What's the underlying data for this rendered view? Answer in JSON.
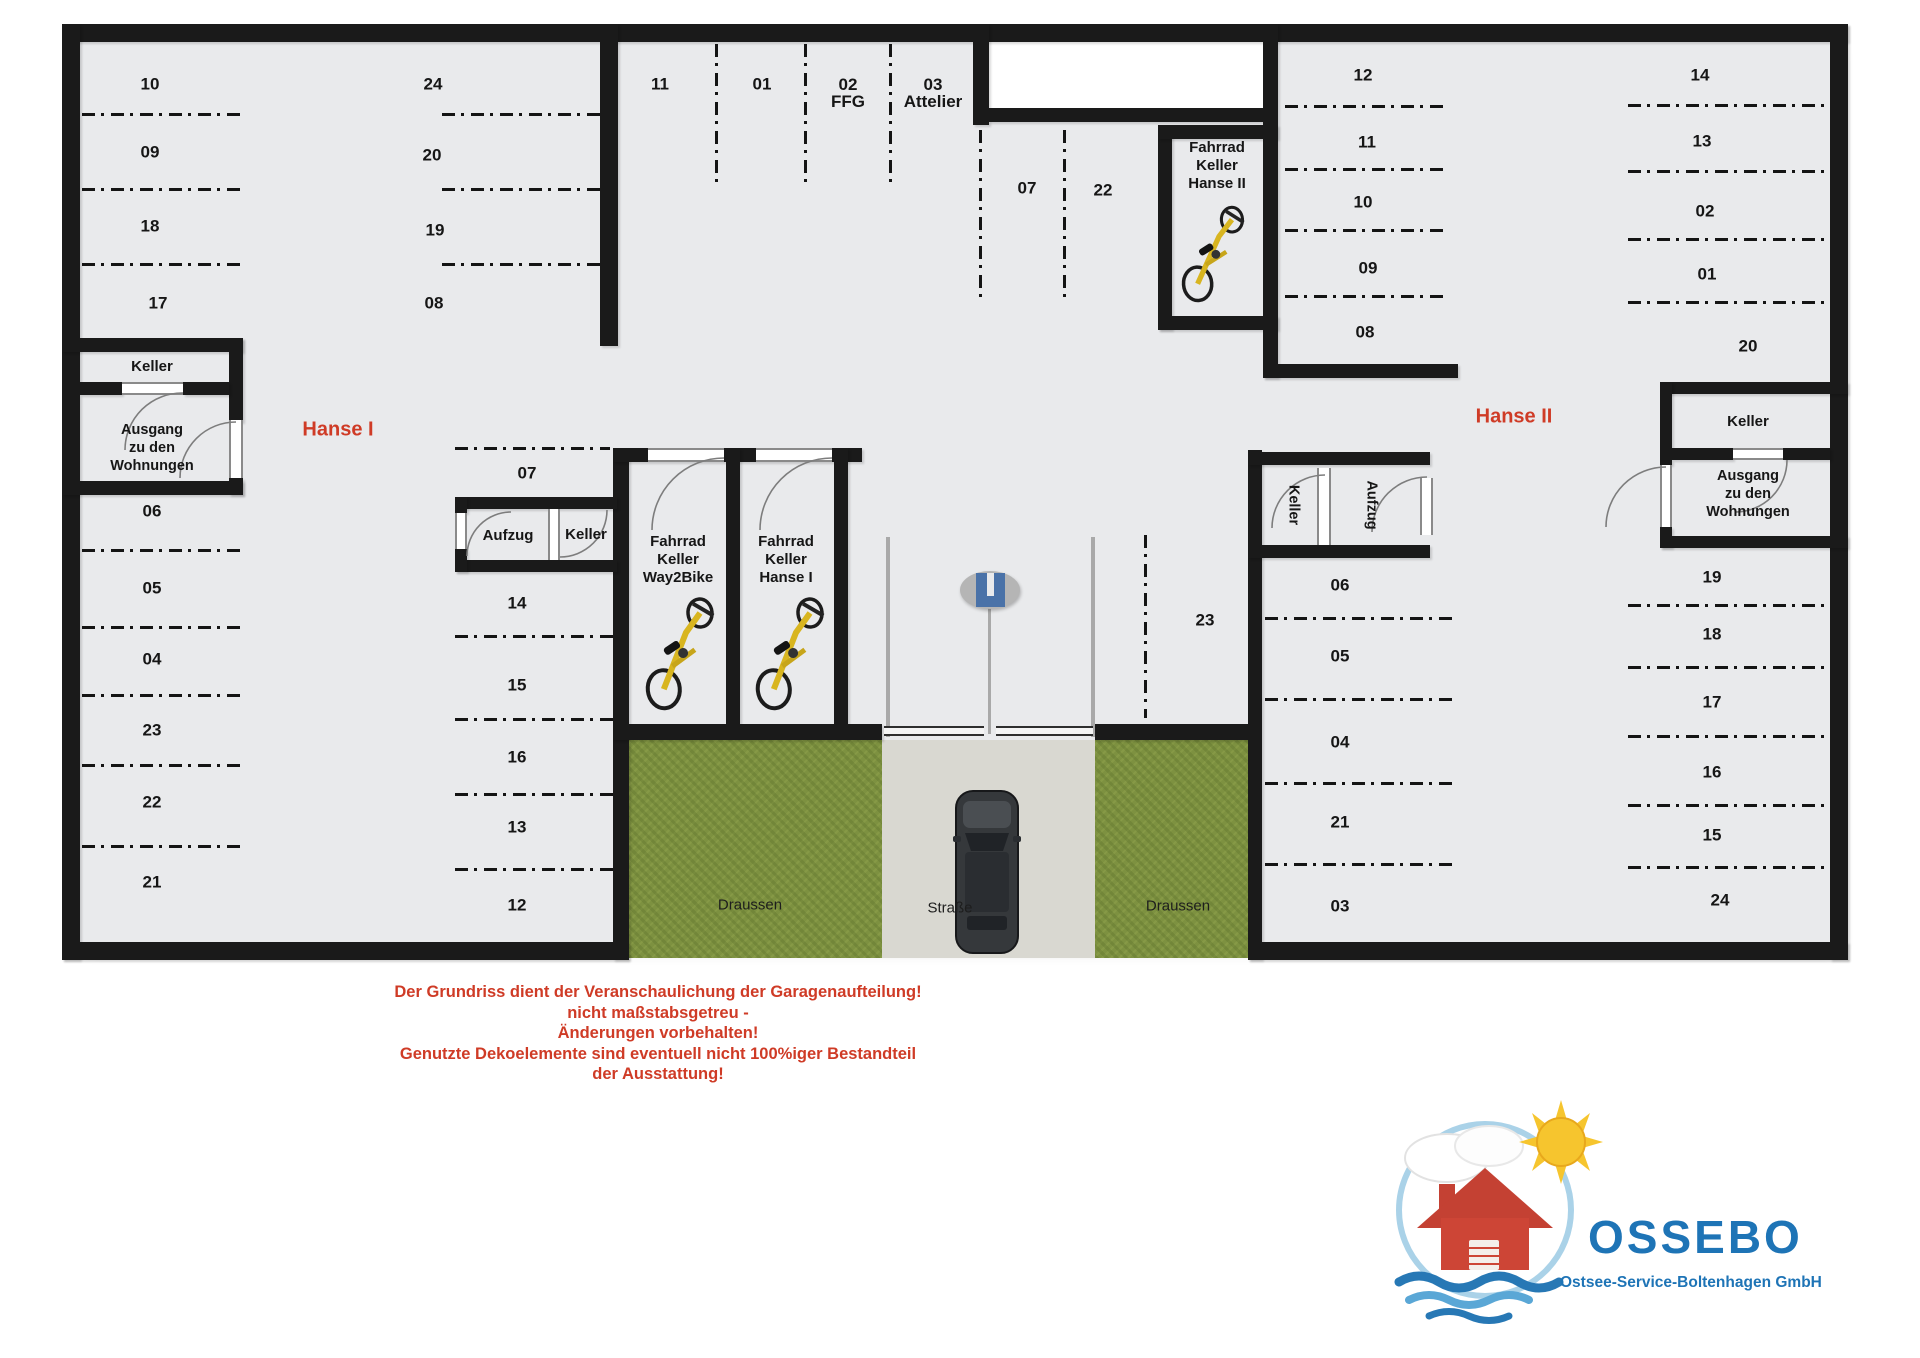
{
  "colors": {
    "accent_red": "#cf3b26",
    "logo_blue": "#1e74b6",
    "wall": "#1a1a1a",
    "floor_gray": "#e9eaec",
    "grass_green": "#7d9140",
    "road_gray": "#d9d8d1",
    "bike_yellow": "#d8b520",
    "sign_blue": "#4a72a8"
  },
  "plan": {
    "building_left": "Hanse I",
    "building_right": "Hanse II",
    "parking_spots": [
      {
        "label": "10",
        "x": 150,
        "y": 84
      },
      {
        "label": "09",
        "x": 150,
        "y": 152
      },
      {
        "label": "18",
        "x": 150,
        "y": 226
      },
      {
        "label": "17",
        "x": 158,
        "y": 303
      },
      {
        "label": "24",
        "x": 433,
        "y": 84
      },
      {
        "label": "20",
        "x": 432,
        "y": 155
      },
      {
        "label": "19",
        "x": 435,
        "y": 230
      },
      {
        "label": "08",
        "x": 434,
        "y": 303
      },
      {
        "label": "11",
        "x": 660,
        "y": 84
      },
      {
        "label": "01",
        "x": 762,
        "y": 84
      },
      {
        "label": "02",
        "line2": "FFG",
        "x": 848,
        "y": 93
      },
      {
        "label": "03",
        "line2": "Attelier",
        "x": 933,
        "y": 93
      },
      {
        "label": "07",
        "x": 1027,
        "y": 188
      },
      {
        "label": "22",
        "x": 1103,
        "y": 190
      },
      {
        "label": "06",
        "x": 152,
        "y": 511
      },
      {
        "label": "05",
        "x": 152,
        "y": 588
      },
      {
        "label": "04",
        "x": 152,
        "y": 659
      },
      {
        "label": "23",
        "x": 152,
        "y": 730
      },
      {
        "label": "22",
        "x": 152,
        "y": 802
      },
      {
        "label": "21",
        "x": 152,
        "y": 882
      },
      {
        "label": "07",
        "x": 527,
        "y": 473
      },
      {
        "label": "14",
        "x": 517,
        "y": 603
      },
      {
        "label": "15",
        "x": 517,
        "y": 685
      },
      {
        "label": "16",
        "x": 517,
        "y": 757
      },
      {
        "label": "13",
        "x": 517,
        "y": 827
      },
      {
        "label": "12",
        "x": 517,
        "y": 905
      },
      {
        "label": "12",
        "x": 1363,
        "y": 75
      },
      {
        "label": "11",
        "x": 1367,
        "y": 142
      },
      {
        "label": "10",
        "x": 1363,
        "y": 202
      },
      {
        "label": "09",
        "x": 1368,
        "y": 268
      },
      {
        "label": "08",
        "x": 1365,
        "y": 332
      },
      {
        "label": "14",
        "x": 1700,
        "y": 75
      },
      {
        "label": "13",
        "x": 1702,
        "y": 141
      },
      {
        "label": "02",
        "x": 1705,
        "y": 211
      },
      {
        "label": "01",
        "x": 1707,
        "y": 274
      },
      {
        "label": "20",
        "x": 1748,
        "y": 346
      },
      {
        "label": "23",
        "x": 1205,
        "y": 620
      },
      {
        "label": "06",
        "x": 1340,
        "y": 585
      },
      {
        "label": "05",
        "x": 1340,
        "y": 656
      },
      {
        "label": "04",
        "x": 1340,
        "y": 742
      },
      {
        "label": "21",
        "x": 1340,
        "y": 822
      },
      {
        "label": "03",
        "x": 1340,
        "y": 906
      },
      {
        "label": "19",
        "x": 1712,
        "y": 577
      },
      {
        "label": "18",
        "x": 1712,
        "y": 634
      },
      {
        "label": "17",
        "x": 1712,
        "y": 702
      },
      {
        "label": "16",
        "x": 1712,
        "y": 772
      },
      {
        "label": "15",
        "x": 1712,
        "y": 835
      },
      {
        "label": "24",
        "x": 1720,
        "y": 900
      }
    ],
    "rooms": {
      "left_keller": "Keller",
      "left_ausgang": "Ausgang\nzu den\nWohnungen",
      "mid_aufzug": "Aufzug",
      "mid_keller": "Keller",
      "bike_way2bike": "Fahrrad\nKeller\nWay2Bike",
      "bike_hanse1": "Fahrrad\nKeller\nHanse I",
      "bike_hanse2": "Fahrrad\nKeller\nHanse II",
      "rot_keller": "Keller",
      "rot_aufzug": "Aufzug",
      "right_keller": "Keller",
      "right_ausgang": "Ausgang\nzu den\nWohnungen"
    },
    "outdoor": {
      "left": "Draussen",
      "street": "Straße",
      "right": "Draussen"
    }
  },
  "disclaimer": {
    "lines": [
      "Der Grundriss dient der Veranschaulichung der Garagenaufteilung!",
      "nicht maßstabsgetreu -",
      "Änderungen vorbehalten!",
      "Genutzte Dekoelemente sind eventuell nicht 100%iger Bestandteil",
      "der Ausstattung!"
    ]
  },
  "logo": {
    "name": "OSSEBO",
    "subtitle": "Ostsee-Service-Boltenhagen GmbH"
  }
}
